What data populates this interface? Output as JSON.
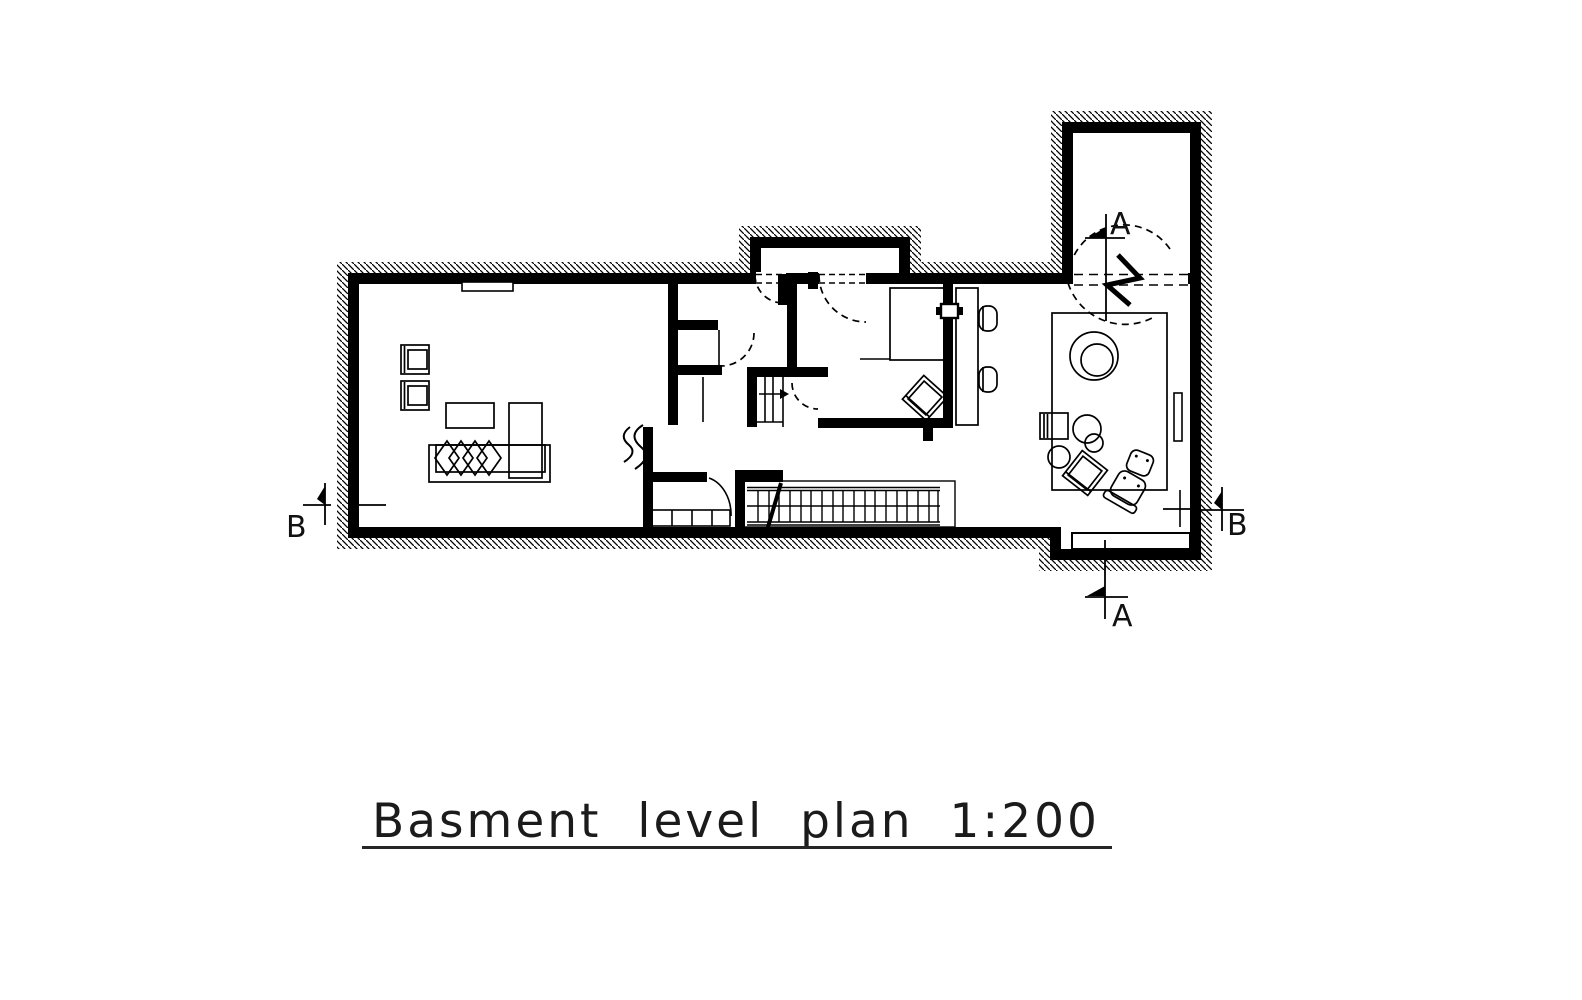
{
  "title": {
    "text": "Basment level plan 1:200",
    "scale": "1:200"
  },
  "markers": {
    "section_a": "A",
    "section_b": "B"
  },
  "colors": {
    "ink": "#000000",
    "paper": "#ffffff"
  }
}
